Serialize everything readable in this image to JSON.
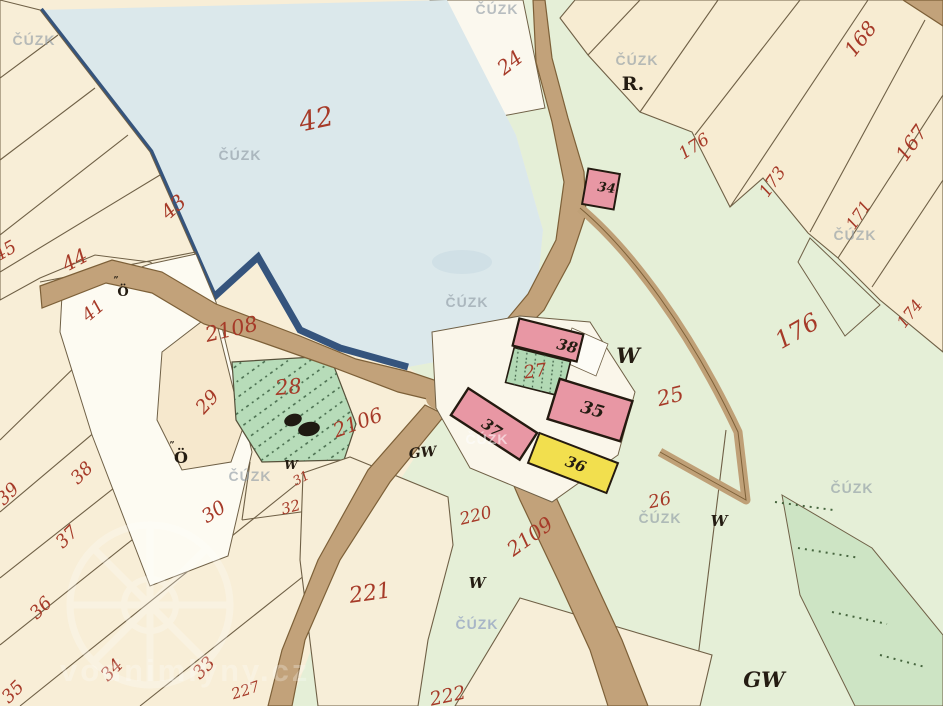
{
  "meta": {
    "description": "Historical hand-drawn cadastral map sheet (Czech imperial imprint style) with pond, roads, farm buildings and numbered parcels"
  },
  "palette": {
    "paper_cream": "#f8eed7",
    "field_green": "#e5efd7",
    "dark_green_band": "#cde4c4",
    "water_blue": "#dbe8eb",
    "shore_navy": "#35547d",
    "road_tan": "#c2a27a",
    "road_edge": "#7d6038",
    "building_pink": "#e897a4",
    "building_yellow": "#f2df4e",
    "building_green": "#b2d9b4",
    "label_red": "#a63a28",
    "label_black": "#241c12",
    "watermark_gray": "#8e9aa4"
  },
  "watermarks": {
    "agency": "ČÚZK",
    "site_text": "vodnimlyny.cz"
  },
  "labels": {
    "water": "42",
    "wedge": {
      "p41": "41",
      "p43": "43",
      "p44": "44",
      "p45": "45"
    },
    "fan": {
      "p33": "33",
      "p34": "34",
      "p35": "35",
      "p36": "36",
      "p37": "37",
      "p38": "38",
      "p39": "39"
    },
    "strips": {
      "p167": "167",
      "p168": "168",
      "p171": "171",
      "p173": "173",
      "p174": "174",
      "p176": "176"
    },
    "fields": {
      "p24": "24",
      "p25": "25",
      "p26": "26",
      "p27": "27",
      "p28": "28",
      "p29": "29",
      "p30": "30",
      "p31": "31",
      "p32": "32",
      "p220": "220",
      "p221": "221",
      "p222": "222"
    },
    "roads": {
      "r2106": "2106",
      "r2108": "2108",
      "r2109": "2109",
      "r227": "227"
    },
    "buildings": {
      "b34": "34",
      "b35": "35",
      "b36": "36",
      "b37": "37",
      "b38": "38"
    },
    "letters": {
      "r": "R.",
      "w": "W",
      "gw": "GW",
      "o": "Ö",
      "ticks": "”"
    }
  }
}
